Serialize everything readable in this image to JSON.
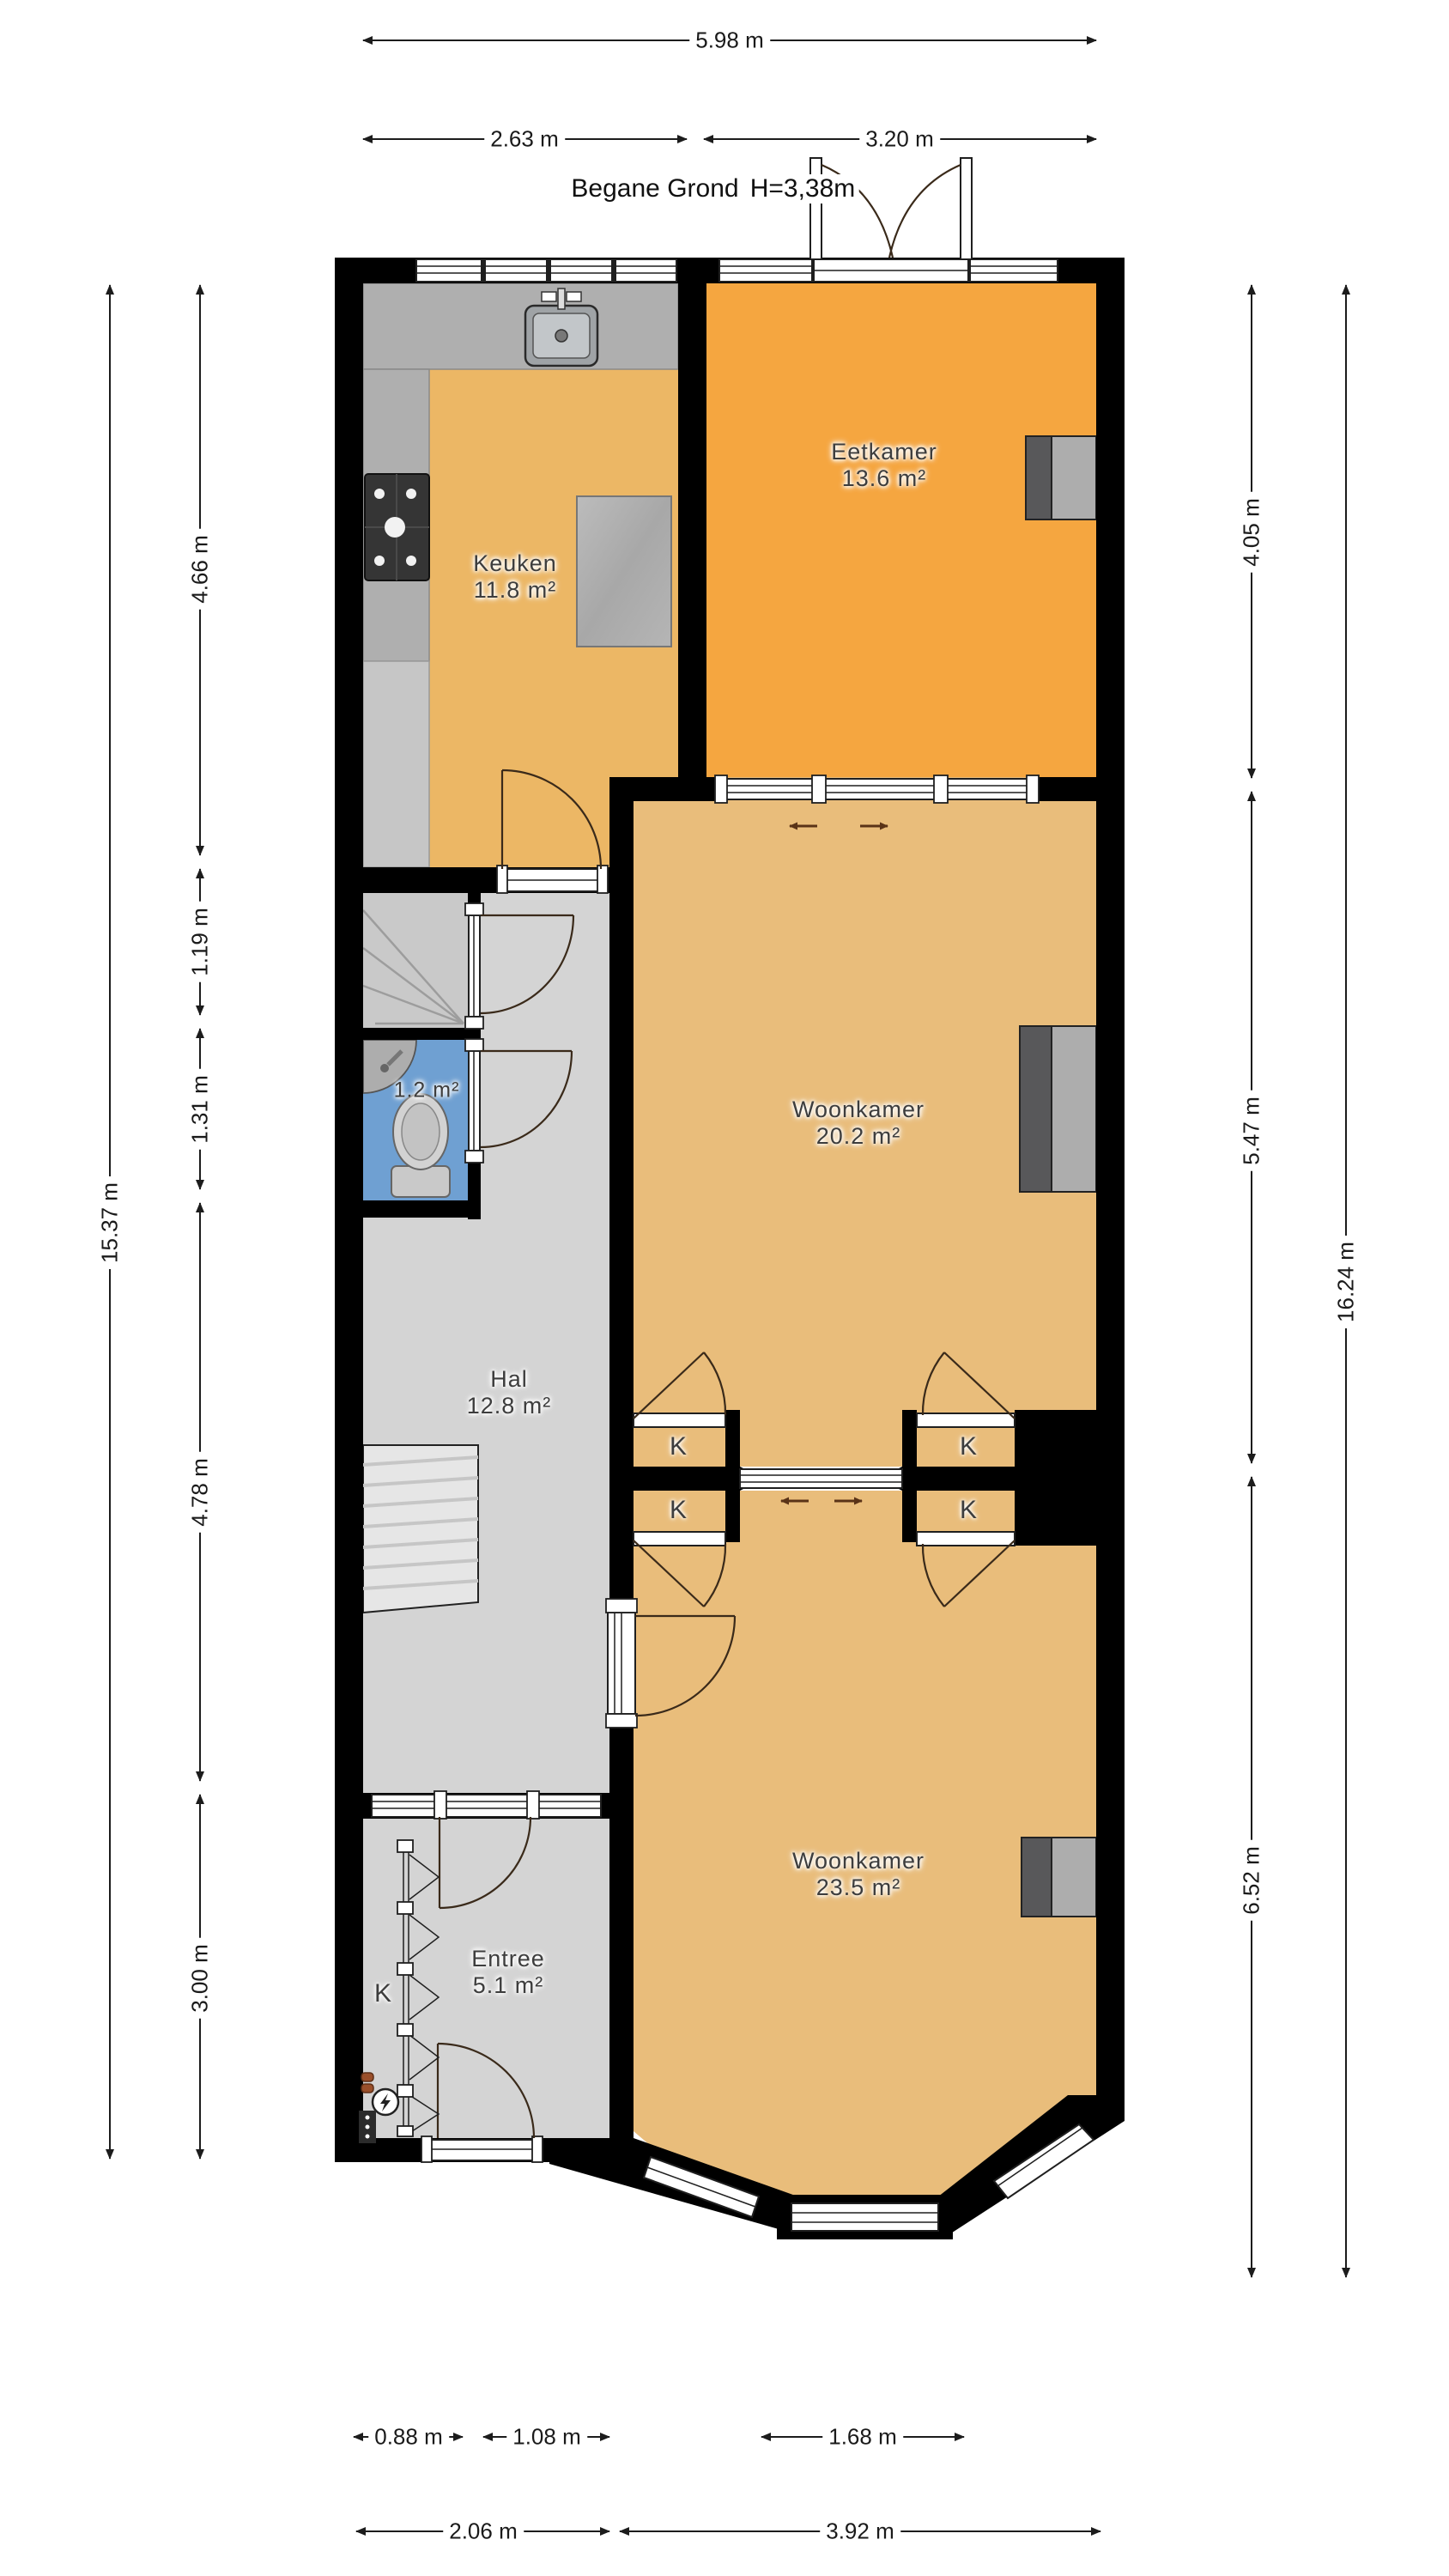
{
  "title": {
    "text": "Begane Grond",
    "height": "H=3,38m"
  },
  "rooms": {
    "keuken": {
      "name": "Keuken",
      "area": "11.8 m²"
    },
    "eetkamer": {
      "name": "Eetkamer",
      "area": "13.6 m²"
    },
    "woonkamer_mid": {
      "name": "Woonkamer",
      "area": "20.2 m²"
    },
    "hal": {
      "name": "Hal",
      "area": "12.8 m²"
    },
    "toilet": {
      "area": "1.2 m²"
    },
    "entree": {
      "name": "Entree",
      "area": "5.1 m²"
    },
    "woonkamer_front": {
      "name": "Woonkamer",
      "area": "23.5 m²"
    }
  },
  "labels": {
    "closet": "K"
  },
  "dimensions": {
    "top": {
      "total": "5.98 m",
      "left": "2.63 m",
      "right": "3.20 m"
    },
    "left": {
      "s1": "4.66 m",
      "s2": "1.19 m",
      "s3": "1.31 m",
      "s4": "4.78 m",
      "s5": "3.00 m",
      "total": "15.37 m"
    },
    "right": {
      "s1": "4.05 m",
      "s2": "5.47 m",
      "s3": "6.52 m",
      "total": "16.24 m"
    },
    "bottom": {
      "s1": "0.88 m",
      "s2": "1.08 m",
      "s3": "1.68 m",
      "w1": "2.06 m",
      "w2": "3.92 m"
    }
  },
  "colors": {
    "wall": "#000000",
    "floor_kitchen": "#ECB765",
    "floor_dining": "#F5A640",
    "floor_living": "#E9BD7B",
    "floor_hall": "#D4D4D4",
    "floor_toilet": "#6FA0D2",
    "furniture_dark": "#58585A",
    "furniture_light": "#ADADAD",
    "arrow_accent": "#5A3317"
  }
}
